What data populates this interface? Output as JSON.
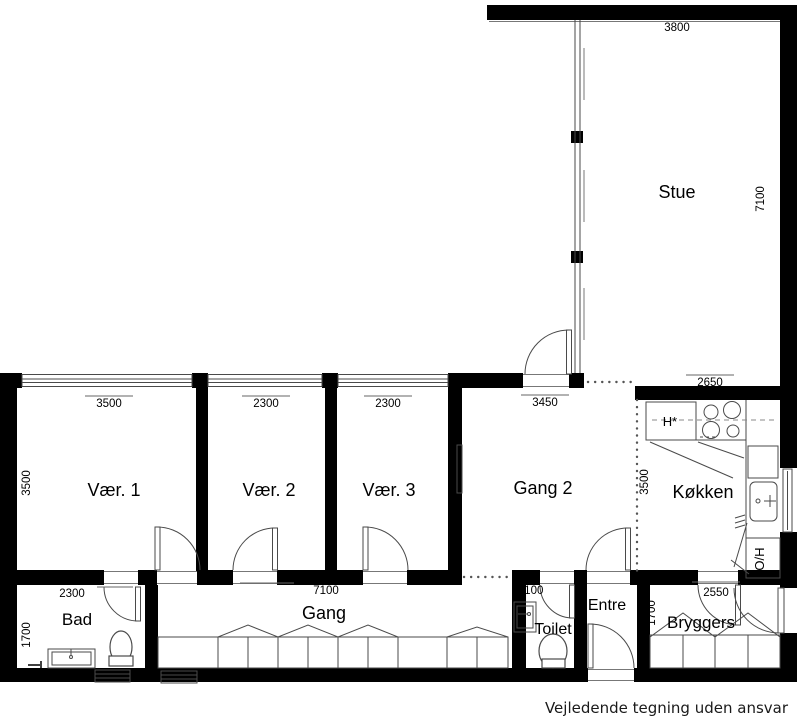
{
  "plan": {
    "rooms": {
      "stue": "Stue",
      "vaer1": "Vær. 1",
      "vaer2": "Vær. 2",
      "vaer3": "Vær. 3",
      "gang2": "Gang 2",
      "koekken": "Køkken",
      "bad": "Bad",
      "gang": "Gang",
      "toilet": "Toilet",
      "entre": "Entre",
      "bryggers": "Bryggers"
    },
    "appliances": {
      "hood": "H*",
      "oven_hob": "O/H"
    },
    "dims": {
      "stue_w": "3800",
      "stue_h": "7100",
      "vaer1_w": "3500",
      "vaer1_h": "3500",
      "vaer2_w": "2300",
      "vaer3_w": "2300",
      "gang2_w": "3450",
      "koekken_w": "2650",
      "koekken_h": "3500",
      "bad_w": "2300",
      "bad_h": "1700",
      "gang_w": "7100",
      "toilet_w": "1100",
      "bryggers_w": "2550",
      "bryggers_h": "1700"
    },
    "footer": "Vejledende tegning uden ansvar",
    "colors": {
      "wall": "#000000",
      "line": "#4a4a4a",
      "bg": "#ffffff"
    }
  }
}
